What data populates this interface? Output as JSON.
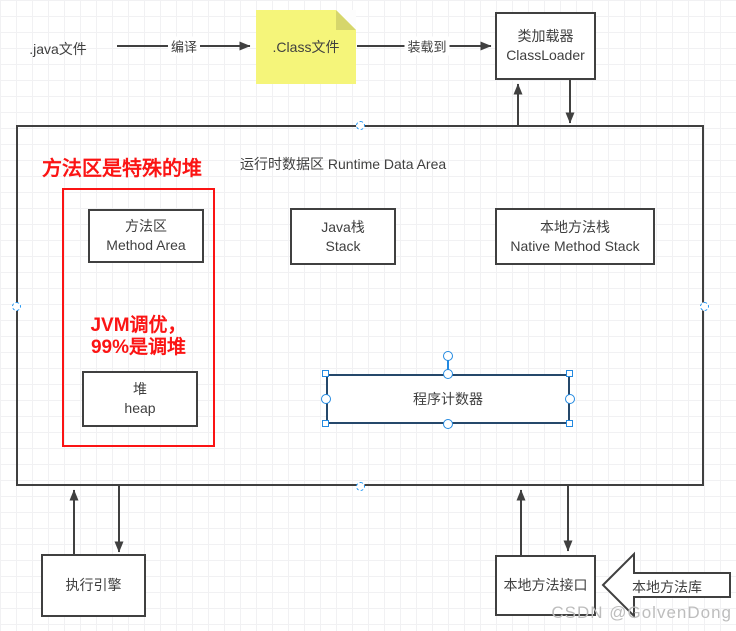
{
  "pipeline": {
    "java_file_label": ".java文件",
    "compile_edge_label": "编译",
    "class_file_note": ".Class文件",
    "load_edge_label": "装载到",
    "classloader_box": {
      "zh": "类加载器",
      "en": "ClassLoader"
    }
  },
  "runtime": {
    "title": "运行时数据区 Runtime Data Area",
    "annotation_heading": "方法区是特殊的堆",
    "tuning_note_line1": "JVM调优，",
    "tuning_note_line2": "99%是调堆",
    "method_area_box": {
      "zh": "方法区",
      "en": "Method Area"
    },
    "java_stack_box": {
      "zh": "Java栈",
      "en": "Stack"
    },
    "native_method_stack_box": {
      "zh": "本地方法栈",
      "en": "Native Method Stack"
    },
    "heap_box": {
      "zh": "堆",
      "en": "heap"
    },
    "program_counter_box": {
      "label": "程序计数器"
    }
  },
  "bottom": {
    "execution_engine_box": "执行引擎",
    "native_method_interface_box": "本地方法接口",
    "native_method_library_arrow": "本地方法库"
  },
  "watermark": "CSDN @GolvenDong",
  "colors": {
    "shape_stroke": "#404040",
    "annotation_red": "#fb1414",
    "note_fill": "#f5f57a",
    "note_fold": "#d6d66b",
    "selected_shape_stroke": "#25486b",
    "selection_handle_blue": "#2389e0",
    "connection_point_blue": "#2196f3",
    "watermark_gray": "#bdbdbd"
  }
}
